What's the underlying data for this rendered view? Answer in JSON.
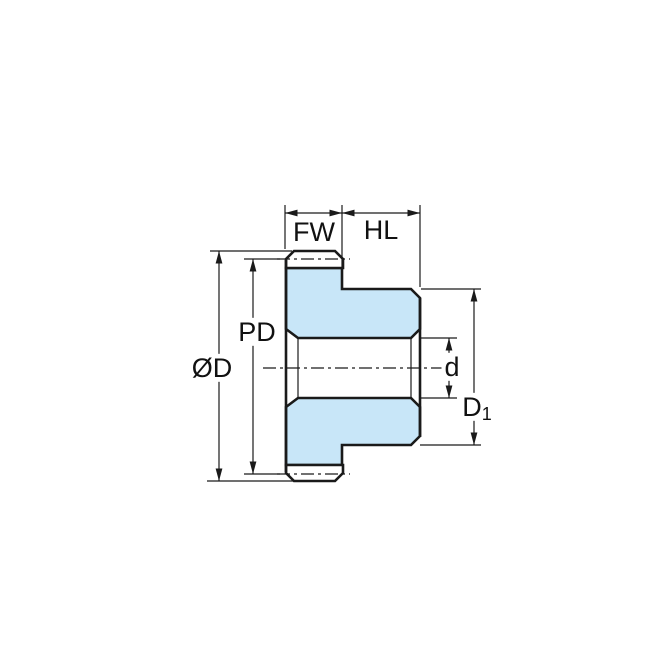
{
  "diagram": {
    "type": "technical-dimension-drawing",
    "subject": "spur gear with hub, side cross-section with dimension callouts",
    "labels": {
      "face_width": "FW",
      "hub_length": "HL",
      "pitch_diameter": "PD",
      "outer_diameter": "ØD",
      "bore_diameter": "d",
      "hub_diameter_main": "D",
      "hub_diameter_sub": "1"
    },
    "colors": {
      "body_fill": "#c8e6f8",
      "line": "#1a1a1a",
      "background": "#ffffff"
    }
  }
}
